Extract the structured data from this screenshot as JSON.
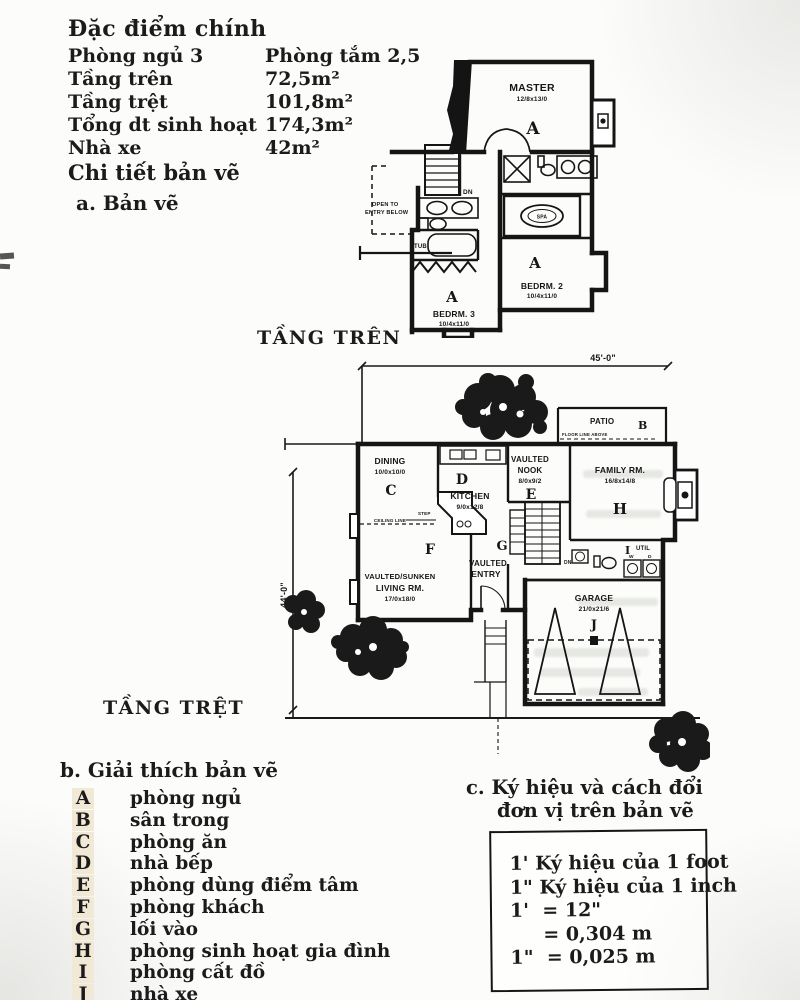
{
  "specs": {
    "title": "Đặc điểm chính",
    "rows": [
      {
        "label": "Phòng ngủ 3",
        "value": "Phòng tắm 2,5"
      },
      {
        "label": "Tầng trên",
        "value": "72,5m²"
      },
      {
        "label": "Tầng trệt",
        "value": "101,8m²"
      },
      {
        "label": "Tổng dt sinh hoạt",
        "value": "174,3m²"
      },
      {
        "label": "Nhà xe",
        "value": "42m²"
      }
    ],
    "details_title": "Chi tiết bản vẽ",
    "drawing_subtitle": "a. Bản vẽ"
  },
  "upper_plan": {
    "caption": "TẦNG TRÊN",
    "rooms": {
      "master": {
        "name": "MASTER",
        "dims": "12/8x13/0",
        "letter": "A"
      },
      "bedrm2": {
        "name": "BEDRM. 2",
        "dims": "10/4x11/0",
        "letter": "A"
      },
      "bedrm3": {
        "name": "BEDRM. 3",
        "dims": "10/4x11/0",
        "letter": "A"
      }
    },
    "labels": {
      "open_below_1": "OPEN TO",
      "open_below_2": "ENTRY BELOW",
      "tub": "TUB",
      "spa": "SPA",
      "dn": "DN"
    }
  },
  "lower_plan": {
    "caption": "TẦNG TRỆT",
    "dim_width": "45'-0\"",
    "dim_height": "44'-0\"",
    "rooms": {
      "patio": {
        "name": "PATIO",
        "letter": "B",
        "note": "FLOOR LINE ABOVE"
      },
      "dining": {
        "name": "DINING",
        "dims": "10/0x10/0",
        "letter": "C"
      },
      "kitchen": {
        "name": "KITCHEN",
        "dims": "9/0x12/8",
        "letter": "D"
      },
      "nook": {
        "name1": "VAULTED",
        "name2": "NOOK",
        "dims": "8/0x9/2",
        "letter": "E"
      },
      "family": {
        "name": "FAMILY RM.",
        "dims": "16/8x14/8",
        "letter": "H"
      },
      "living": {
        "name1": "VAULTED/SUNKEN",
        "name2": "LIVING RM.",
        "dims": "17/0x18/0",
        "letter": "F"
      },
      "entry": {
        "name1": "VAULTED",
        "name2": "ENTRY",
        "letter": "G"
      },
      "util": {
        "name": "UTIL",
        "letter": "I",
        "washer": "W",
        "dryer": "D"
      },
      "garage": {
        "name": "GARAGE",
        "dims": "21/0x21/6",
        "letter": "J"
      }
    },
    "labels": {
      "step": "STEP",
      "ceiling_line": "CEILING LINE",
      "dn": "DN"
    }
  },
  "legend": {
    "title": "b. Giải thích bản vẽ",
    "items": [
      {
        "key": "A",
        "label": "phòng ngủ"
      },
      {
        "key": "B",
        "label": "sân trong"
      },
      {
        "key": "C",
        "label": "phòng ăn"
      },
      {
        "key": "D",
        "label": "nhà bếp"
      },
      {
        "key": "E",
        "label": "phòng dùng điểm tâm"
      },
      {
        "key": "F",
        "label": "phòng khách"
      },
      {
        "key": "G",
        "label": "lối vào"
      },
      {
        "key": "H",
        "label": "phòng sinh hoạt gia đình"
      },
      {
        "key": "I",
        "label": "phòng cất đồ"
      },
      {
        "key": "J",
        "label": "nhà xe"
      }
    ]
  },
  "units": {
    "title_1": "c. Ký hiệu và cách đổi",
    "title_2": "đơn vị trên bản vẽ",
    "lines": [
      "1' Ký hiệu của 1 foot",
      "1\" Ký hiệu của 1 inch",
      "1'  = 12\"",
      "     = 0,304 m",
      "1\"  = 0,025 m"
    ]
  }
}
